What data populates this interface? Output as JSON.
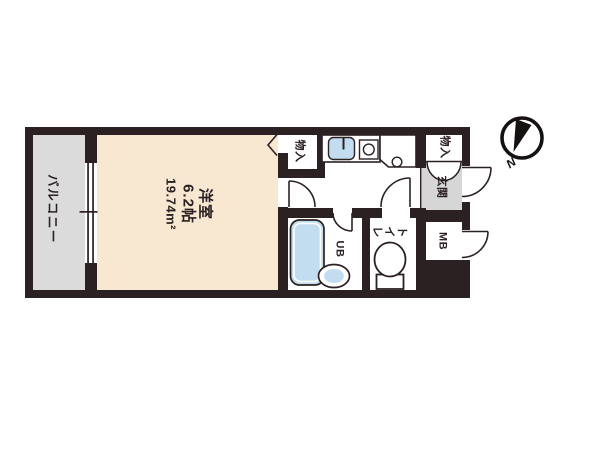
{
  "plan_title": "1K floor plan",
  "rooms": {
    "balcony": {
      "label": "バルコニー"
    },
    "western_room": {
      "label": "洋室",
      "size": "6.2帖",
      "area": "19.74m²"
    },
    "closet_kitchen": {
      "label": "物入"
    },
    "closet_entrance": {
      "label": "物入"
    },
    "entrance": {
      "label": "玄関"
    },
    "meter_box": {
      "label": "MB"
    },
    "unit_bath": {
      "label": "UB"
    },
    "toilet": {
      "label": "トイレ"
    }
  },
  "compass": {
    "north_label": "N"
  },
  "colors": {
    "wall": "#2b2123",
    "room_fill": "#f9e8d1",
    "balcony_fill": "#dbdbdb",
    "entrance_fill": "#d6d6d6",
    "fixture_blue": "#c3ddf0",
    "line": "#2b2123"
  }
}
